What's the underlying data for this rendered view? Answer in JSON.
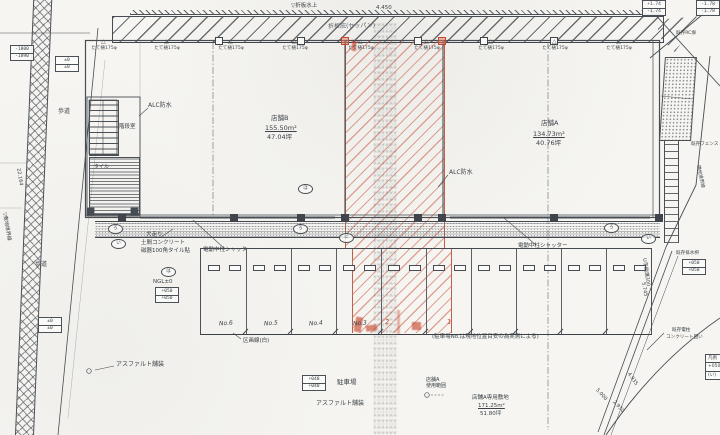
{
  "drawing": {
    "kind": "scanned architectural site / floor plan",
    "ink_color": "#474d53",
    "red_color": "#c8472e",
    "paper_color": "#f6f5f1"
  },
  "labels": [
    {
      "name": "note-eave-top",
      "text": "▽折板水上",
      "x": 291,
      "y": 3,
      "fs": 5.5
    },
    {
      "name": "dim-top",
      "text": "4.450",
      "x": 376,
      "y": 5,
      "fs": 5.5
    },
    {
      "name": "note-canopy",
      "text": "折板庇(セッパン)",
      "x": 328,
      "y": 24,
      "fs": 6,
      "color": "#5b6166",
      "rot": -1
    },
    {
      "name": "note-alc-left",
      "text": "ALC防水",
      "x": 148,
      "y": 103,
      "fs": 6
    },
    {
      "name": "note-alc-right",
      "text": "ALC防水",
      "x": 449,
      "y": 170,
      "fs": 6
    },
    {
      "name": "room-b-name",
      "text": "店舗B",
      "x": 271,
      "y": 115,
      "fs": 6.5
    },
    {
      "name": "room-b-area",
      "text": "155.50m²",
      "x": 265,
      "y": 125,
      "fs": 6.5,
      "u": 1
    },
    {
      "name": "room-b-tsubo",
      "text": "47.04坪",
      "x": 267,
      "y": 134,
      "fs": 6.5
    },
    {
      "name": "room-a-name",
      "text": "店舗A",
      "x": 541,
      "y": 120,
      "fs": 6.5
    },
    {
      "name": "room-a-area",
      "text": "134.73m²",
      "x": 533,
      "y": 131,
      "fs": 6.5,
      "u": 1
    },
    {
      "name": "room-a-tsubo",
      "text": "40.76坪",
      "x": 536,
      "y": 140,
      "fs": 6.5
    },
    {
      "name": "room-stair",
      "text": "階段室",
      "x": 119,
      "y": 124,
      "fs": 5.5
    },
    {
      "name": "note-tile",
      "text": "タイル",
      "x": 94,
      "y": 165,
      "fs": 5
    },
    {
      "name": "note-sidewalk-1",
      "text": "歩道",
      "x": 58,
      "y": 109,
      "fs": 6
    },
    {
      "name": "note-sidewalk-2",
      "text": "歩道",
      "x": 35,
      "y": 262,
      "fs": 6
    },
    {
      "name": "note-inubashiri-1",
      "text": "犬走り",
      "x": 146,
      "y": 232,
      "fs": 5.5
    },
    {
      "name": "note-inubashiri-2",
      "text": "土間コンクリート",
      "x": 141,
      "y": 240,
      "fs": 5.5
    },
    {
      "name": "note-inubashiri-3",
      "text": "磁器100角タイル貼",
      "x": 141,
      "y": 248,
      "fs": 5.5
    },
    {
      "name": "note-shutter-left",
      "text": "電動中柱シャッター",
      "x": 203,
      "y": 247,
      "fs": 5.5
    },
    {
      "name": "note-shutter-right",
      "text": "電動中柱シャッター",
      "x": 518,
      "y": 243,
      "fs": 5.5
    },
    {
      "name": "note-ngl",
      "text": "NGL±0",
      "x": 153,
      "y": 279,
      "fs": 5.5
    },
    {
      "name": "note-lane-line",
      "text": "区画線(白)",
      "x": 243,
      "y": 338,
      "fs": 5.5
    },
    {
      "name": "note-parking-no",
      "text": "(駐車場No.は現地位置目安の為実測による)",
      "x": 432,
      "y": 334,
      "fs": 5.5
    },
    {
      "name": "note-parking-lot",
      "text": "駐車場",
      "x": 337,
      "y": 379,
      "fs": 6.5
    },
    {
      "name": "note-asphalt-center",
      "text": "アスファルト舗装",
      "x": 316,
      "y": 401,
      "fs": 6
    },
    {
      "name": "note-asphalt-left",
      "text": "アスファルト舗装",
      "x": 116,
      "y": 362,
      "fs": 6
    },
    {
      "name": "note-a-range-1",
      "text": "店舗A",
      "x": 426,
      "y": 378,
      "fs": 5
    },
    {
      "name": "note-a-range-2",
      "text": "使用範囲",
      "x": 426,
      "y": 384,
      "fs": 5
    },
    {
      "name": "note-a-site",
      "text": "店舗A専用敷地",
      "x": 472,
      "y": 395,
      "fs": 5.5
    },
    {
      "name": "note-a-site-area",
      "text": "171.25m²",
      "x": 478,
      "y": 403,
      "fs": 5.5,
      "u": 1
    },
    {
      "name": "note-a-site-tsubo",
      "text": "51.80坪",
      "x": 480,
      "y": 411,
      "fs": 5.5
    },
    {
      "name": "note-boundary-left",
      "text": "▽敷地境界線",
      "x": 6,
      "y": 212,
      "fs": 5,
      "rot": 80
    },
    {
      "name": "dim-left",
      "text": "22.164",
      "x": 20,
      "y": 168,
      "fs": 5,
      "rot": 80
    },
    {
      "name": "note-gutter",
      "text": "U字側溝300",
      "x": 646,
      "y": 258,
      "fs": 5,
      "rot": 82
    },
    {
      "name": "note-drain",
      "text": "既存排水桝",
      "x": 676,
      "y": 251,
      "fs": 4.6
    },
    {
      "name": "note-pole-1",
      "text": "既存電柱",
      "x": 672,
      "y": 328,
      "fs": 4.6
    },
    {
      "name": "note-pole-2",
      "text": "コンクリート囲い",
      "x": 666,
      "y": 335,
      "fs": 4.6
    },
    {
      "name": "note-fence",
      "text": "既存フェンス",
      "x": 691,
      "y": 142,
      "fs": 4.6
    },
    {
      "name": "note-boundary-right",
      "text": "隣地境界線",
      "x": 700,
      "y": 165,
      "fs": 4.6,
      "rot": 78
    },
    {
      "name": "dim-road-1",
      "text": "5.745",
      "x": 645,
      "y": 282,
      "fs": 5,
      "rot": 80
    },
    {
      "name": "dim-road-2",
      "text": "4.935",
      "x": 630,
      "y": 372,
      "fs": 5,
      "rot": 55
    },
    {
      "name": "dim-road-3",
      "text": "2.930",
      "x": 615,
      "y": 400,
      "fs": 5,
      "rot": 48
    },
    {
      "name": "dim-road-4",
      "text": "5.000",
      "x": 598,
      "y": 388,
      "fs": 5,
      "rot": 48
    },
    {
      "name": "note-rc-wall",
      "text": "既存RC塀",
      "x": 676,
      "y": 31,
      "fs": 4.6
    }
  ],
  "elevation_boxes": [
    {
      "name": "level-box-road-top",
      "x": 10,
      "y": 45,
      "rows": [
        "-1800",
        "-1890"
      ]
    },
    {
      "name": "level-box-entry",
      "x": 55,
      "y": 56,
      "rows": [
        "±0",
        "±0"
      ]
    },
    {
      "name": "level-box-walk",
      "x": 155,
      "y": 287,
      "rows": [
        "+050",
        "+050"
      ]
    },
    {
      "name": "level-box-lot",
      "x": 302,
      "y": 375,
      "rows": [
        "+040",
        "+040"
      ]
    },
    {
      "name": "level-box-left-low",
      "x": 38,
      "y": 317,
      "rows": [
        "±0",
        "±0"
      ]
    },
    {
      "name": "level-box-ne-1",
      "x": 642,
      "y": 0,
      "rows": [
        "+1.74",
        "-1.74"
      ]
    },
    {
      "name": "level-box-ne-2",
      "x": 696,
      "y": 0,
      "rows": [
        "-1.78",
        "-1.78"
      ]
    },
    {
      "name": "level-box-drain",
      "x": 682,
      "y": 259,
      "rows": [
        "+050",
        "+050"
      ]
    }
  ],
  "downspouts": {
    "label": "たて樋175φ",
    "tri_y": 39,
    "label_y": 45,
    "xs": [
      104,
      167,
      231,
      295,
      361,
      427,
      491,
      555,
      619
    ]
  },
  "columns": {
    "top_y": 37,
    "bottom_y": 214,
    "top_white": [
      215,
      297,
      414,
      480,
      550
    ],
    "top_red": [
      341,
      438
    ],
    "bottom_dark": [
      118,
      230,
      297,
      341,
      414,
      438,
      550,
      655
    ]
  },
  "ref_marks": [
    {
      "x": 108,
      "y": 224,
      "t": "ろ"
    },
    {
      "x": 111,
      "y": 239,
      "t": "い"
    },
    {
      "x": 161,
      "y": 267,
      "t": "は"
    },
    {
      "x": 293,
      "y": 224,
      "t": "ろ"
    },
    {
      "x": 339,
      "y": 233,
      "t": "に"
    },
    {
      "x": 604,
      "y": 223,
      "t": "ろ"
    },
    {
      "x": 641,
      "y": 234,
      "t": "い"
    },
    {
      "x": 298,
      "y": 184,
      "t": "ほ"
    }
  ],
  "stalls": {
    "x": 200,
    "y": 248,
    "width": 450,
    "height": 85,
    "stall_w": 45,
    "count": 10,
    "wheel_y": 16,
    "numbers": [
      {
        "x": 218,
        "t": "No.6"
      },
      {
        "x": 263,
        "t": "No.5"
      },
      {
        "x": 308,
        "t": "No.4"
      },
      {
        "x": 352,
        "t": "No.3"
      }
    ],
    "red_numbers": [
      {
        "x": 384,
        "t": "2"
      },
      {
        "x": 446,
        "t": "1"
      }
    ]
  },
  "legend": {
    "x": 705,
    "y": 354,
    "rows": [
      "凡例",
      "+050",
      "(い)"
    ]
  }
}
